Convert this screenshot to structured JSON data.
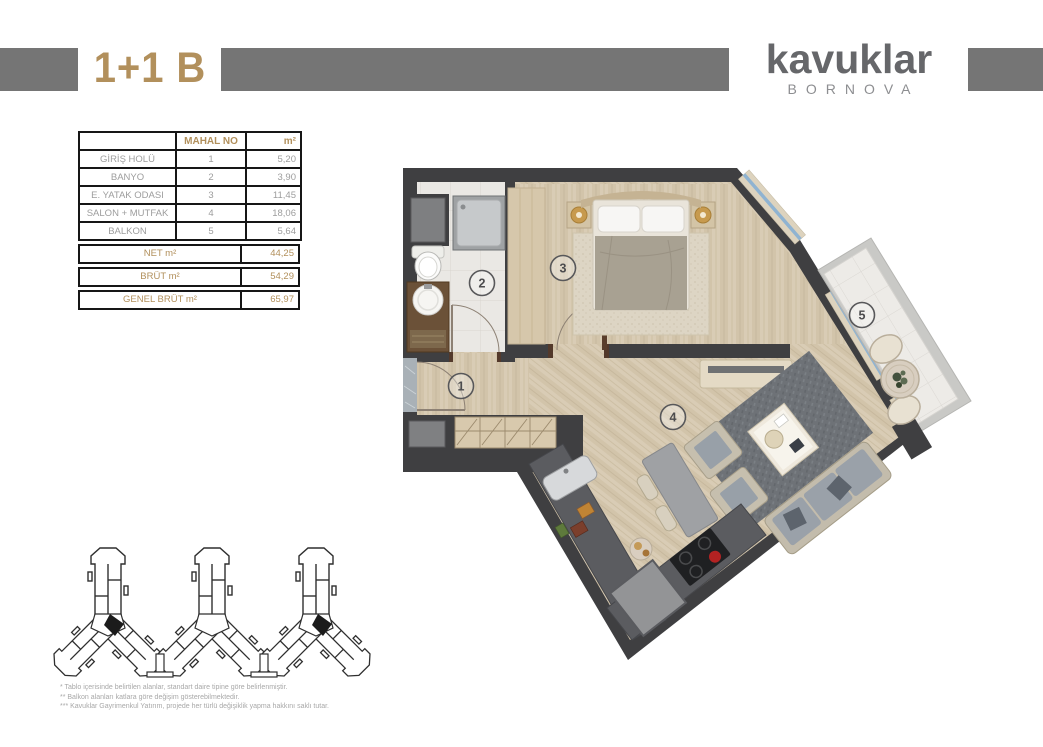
{
  "header": {
    "unit_type": "1+1 B",
    "brand_name": "kavuklar",
    "brand_subtitle": "BORNOVA"
  },
  "area_table": {
    "headers": {
      "room": "",
      "unit_no": "MAHAL NO",
      "area": "m²"
    },
    "rows": [
      {
        "room": "GİRİŞ HOLÜ",
        "no": "1",
        "area": "5,20"
      },
      {
        "room": "BANYO",
        "no": "2",
        "area": "3,90"
      },
      {
        "room": "E. YATAK ODASI",
        "no": "3",
        "area": "11,45"
      },
      {
        "room": "SALON + MUTFAK",
        "no": "4",
        "area": "18,06"
      },
      {
        "room": "BALKON",
        "no": "5",
        "area": "5,64"
      }
    ],
    "totals": [
      {
        "label": "NET m²",
        "value": "44,25"
      },
      {
        "label": "BRÜT m²",
        "value": "54,29"
      },
      {
        "label": "GENEL BRÜT m²",
        "value": "65,97"
      }
    ]
  },
  "floor_plan": {
    "room_numbers": [
      "1",
      "2",
      "3",
      "4",
      "5"
    ]
  },
  "footnotes": {
    "lines": [
      "* Tablo içerisinde belirtilen alanlar, standart daire tipine göre belirlenmiştir.",
      "** Balkon alanları katlara göre değişim gösterebilmektedir.",
      "*** Kavuklar Gayrimenkul Yatırım, projede her türlü değişiklik yapma hakkını saklı tutar."
    ]
  },
  "colors": {
    "gold": "#b2905c",
    "header_bar": "#757575",
    "wall": "#3f3f41",
    "brand_gray": "#66676a"
  }
}
